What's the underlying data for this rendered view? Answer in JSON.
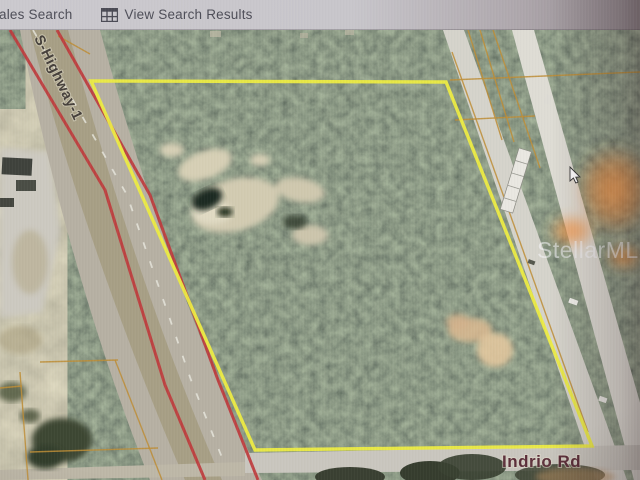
{
  "toolbar": {
    "sales_search_label": "ales Search",
    "view_results_label": "View Search Results",
    "view_results_icon": "table-grid-icon"
  },
  "map": {
    "type": "aerial-satellite",
    "watermark": "StellarMLS",
    "labels": {
      "highway": "S-Highway-1",
      "road_bottom": "Indrio Rd"
    },
    "colors": {
      "parcel_boundary": "#edeb3d",
      "route_highlight": "#c23a3c",
      "parcel_lines": "#bf8d33"
    },
    "parcel_boundary_points": "91,81 446,82 592,446 255,450",
    "route_lines": [
      "10,30 105,190 165,385 205,480",
      "57,30 150,195 218,380 258,480"
    ],
    "lane_dash_points": "33,30 127,195 191,380 231,480",
    "parcel_lines": [
      "468,30 502,140",
      "480,30 514,142",
      "493,30 540,168",
      "452,52 588,432",
      "450,80 640,72",
      "455,120 535,116",
      "20,372 28,480",
      "30,452 158,448",
      "40,362 118,360",
      "115,360 162,480",
      "0,388 22,386",
      "58,36 90,54"
    ]
  }
}
